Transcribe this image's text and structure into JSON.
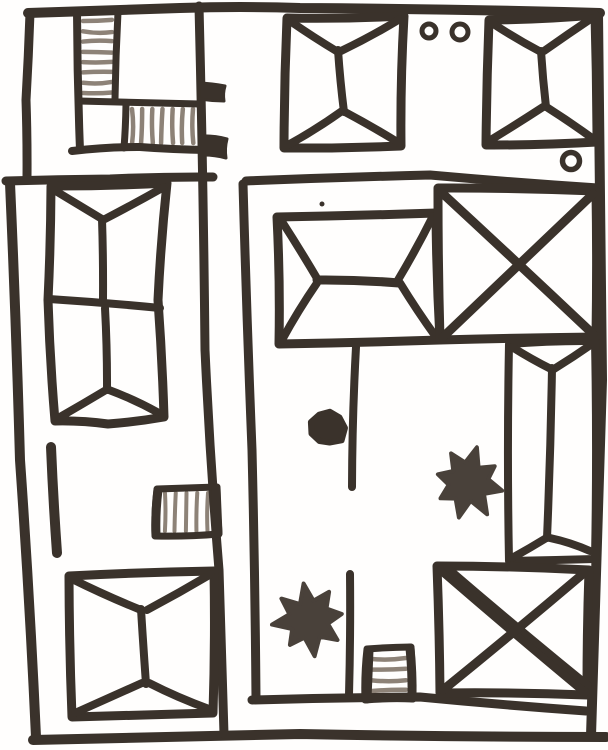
{
  "meta": {
    "description": "Hand-drawn black marker sketch of a walled compound map: hip-roofed buildings, X-roof buildings, hatched stair strips, star and dot markers, small circles. No text labels.",
    "canvas": {
      "w": 608,
      "h": 750
    }
  },
  "palette": {
    "ink": "#3a322b",
    "soft": "#49413a",
    "hatch": "#8d8277",
    "paper": "#fffefd"
  },
  "strokes": [
    {
      "name": "border-top",
      "pts": [
        [
          28,
          13
        ],
        [
          180,
          8
        ],
        [
          300,
          8
        ],
        [
          600,
          13
        ]
      ],
      "w": 10
    },
    {
      "name": "border-top-left-vertical",
      "pts": [
        [
          30,
          13
        ],
        [
          26,
          100
        ],
        [
          27,
          178
        ]
      ],
      "w": 9
    },
    {
      "name": "left-section-top-wall",
      "pts": [
        [
          6,
          181
        ],
        [
          110,
          179
        ],
        [
          213,
          177
        ]
      ],
      "w": 9
    },
    {
      "name": "border-left",
      "pts": [
        [
          10,
          183
        ],
        [
          20,
          460
        ],
        [
          36,
          737
        ]
      ],
      "w": 10
    },
    {
      "name": "border-right",
      "pts": [
        [
          598,
          14
        ],
        [
          602,
          380
        ],
        [
          591,
          736
        ]
      ],
      "w": 10
    },
    {
      "name": "border-bottom",
      "pts": [
        [
          33,
          740
        ],
        [
          300,
          734
        ],
        [
          606,
          737
        ]
      ],
      "w": 10
    },
    {
      "name": "street-wall",
      "pts": [
        [
          199,
          6
        ],
        [
          205,
          350
        ],
        [
          219,
          570
        ],
        [
          224,
          734
        ]
      ],
      "w": 9
    },
    {
      "name": "courtyard-left-wall",
      "pts": [
        [
          243,
          184
        ],
        [
          252,
          450
        ],
        [
          256,
          698
        ]
      ],
      "w": 9
    },
    {
      "name": "courtyard-top-wall",
      "pts": [
        [
          246,
          181
        ],
        [
          430,
          175
        ],
        [
          598,
          188
        ]
      ],
      "w": 9
    },
    {
      "name": "courtyard-bottom-wall",
      "pts": [
        [
          252,
          700
        ],
        [
          420,
          697
        ],
        [
          586,
          711
        ]
      ],
      "w": 9
    },
    {
      "name": "stairs-block-left-wall",
      "pts": [
        [
          77,
          12
        ],
        [
          80,
          150
        ]
      ],
      "w": 8
    },
    {
      "name": "stairs-block-bottom-wall",
      "pts": [
        [
          72,
          151
        ],
        [
          140,
          147
        ],
        [
          207,
          150
        ]
      ],
      "w": 8
    },
    {
      "name": "stairs-strip-right-wall",
      "pts": [
        [
          118,
          12
        ],
        [
          115,
          99
        ]
      ],
      "w": 7
    },
    {
      "name": "stairs-strip-bottom-wall",
      "pts": [
        [
          79,
          101
        ],
        [
          200,
          104
        ]
      ],
      "w": 7
    },
    {
      "name": "stairs-box-left-wall",
      "pts": [
        [
          126,
          104
        ],
        [
          124,
          148
        ]
      ],
      "w": 7
    },
    {
      "name": "building-top-middle-outline",
      "pts": [
        [
          287,
          18
        ],
        [
          404,
          16
        ],
        [
          401,
          146
        ],
        [
          284,
          148
        ]
      ],
      "closed": true,
      "w": 9
    },
    {
      "name": "building-top-middle-ridge",
      "pts": [
        [
          338,
          50
        ],
        [
          344,
          112
        ]
      ],
      "w": 8
    },
    {
      "name": "building-top-middle-hip-nw",
      "pts": [
        [
          290,
          21
        ],
        [
          338,
          52
        ]
      ],
      "w": 8
    },
    {
      "name": "building-top-middle-hip-ne",
      "pts": [
        [
          400,
          19
        ],
        [
          341,
          51
        ]
      ],
      "w": 8
    },
    {
      "name": "building-top-middle-hip-sw",
      "pts": [
        [
          288,
          145
        ],
        [
          342,
          111
        ]
      ],
      "w": 8
    },
    {
      "name": "building-top-middle-hip-se",
      "pts": [
        [
          399,
          143
        ],
        [
          345,
          112
        ]
      ],
      "w": 8
    },
    {
      "name": "building-top-right-outline",
      "pts": [
        [
          489,
          20
        ],
        [
          595,
          15
        ],
        [
          597,
          142
        ],
        [
          486,
          145
        ]
      ],
      "closed": true,
      "w": 9
    },
    {
      "name": "building-top-right-ridge",
      "pts": [
        [
          541,
          51
        ],
        [
          546,
          107
        ]
      ],
      "w": 8
    },
    {
      "name": "building-top-right-hip-nw",
      "pts": [
        [
          492,
          23
        ],
        [
          541,
          52
        ]
      ],
      "w": 8
    },
    {
      "name": "building-top-right-hip-ne",
      "pts": [
        [
          592,
          18
        ],
        [
          544,
          51
        ]
      ],
      "w": 8
    },
    {
      "name": "building-top-right-hip-sw",
      "pts": [
        [
          489,
          141
        ],
        [
          543,
          107
        ]
      ],
      "w": 8
    },
    {
      "name": "building-top-right-hip-se",
      "pts": [
        [
          592,
          138
        ],
        [
          548,
          108
        ]
      ],
      "w": 8
    },
    {
      "name": "building-left-outline",
      "pts": [
        [
          51,
          186
        ],
        [
          167,
          183
        ],
        [
          158,
          300
        ],
        [
          164,
          417
        ],
        [
          108,
          424
        ],
        [
          55,
          421
        ],
        [
          48,
          300
        ]
      ],
      "closed": true,
      "w": 9
    },
    {
      "name": "building-left-hip-nw",
      "pts": [
        [
          54,
          190
        ],
        [
          102,
          219
        ]
      ],
      "w": 8
    },
    {
      "name": "building-left-hip-ne",
      "pts": [
        [
          164,
          187
        ],
        [
          105,
          219
        ]
      ],
      "w": 8
    },
    {
      "name": "building-left-ridge-upper",
      "pts": [
        [
          102,
          219
        ],
        [
          103,
          299
        ]
      ],
      "w": 8
    },
    {
      "name": "building-left-divider",
      "pts": [
        [
          49,
          299
        ],
        [
          160,
          308
        ]
      ],
      "w": 8
    },
    {
      "name": "building-left-ridge-lower",
      "pts": [
        [
          105,
          308
        ],
        [
          107,
          390
        ]
      ],
      "w": 8
    },
    {
      "name": "building-left-hip-sw",
      "pts": [
        [
          60,
          417
        ],
        [
          106,
          390
        ]
      ],
      "w": 8
    },
    {
      "name": "building-left-hip-se",
      "pts": [
        [
          157,
          412
        ],
        [
          109,
          390
        ]
      ],
      "w": 8
    },
    {
      "name": "wall-fragment",
      "pts": [
        [
          51,
          447
        ],
        [
          57,
          553
        ]
      ],
      "w": 10
    },
    {
      "name": "stairs-left-outline",
      "pts": [
        [
          157,
          489
        ],
        [
          217,
          487
        ],
        [
          219,
          534
        ],
        [
          155,
          536
        ]
      ],
      "closed": true,
      "w": 7
    },
    {
      "name": "stairs-left-edge-left",
      "pts": [
        [
          158,
          490
        ],
        [
          156,
          535
        ]
      ],
      "w": 9
    },
    {
      "name": "stairs-left-edge-right",
      "pts": [
        [
          216,
          488
        ],
        [
          218,
          533
        ]
      ],
      "w": 9
    },
    {
      "name": "building-bottom-left-outline",
      "pts": [
        [
          69,
          576
        ],
        [
          214,
          571
        ],
        [
          213,
          713
        ],
        [
          72,
          717
        ]
      ],
      "closed": true,
      "w": 9
    },
    {
      "name": "building-bottom-left-ridge",
      "pts": [
        [
          141,
          609
        ],
        [
          146,
          684
        ]
      ],
      "w": 8
    },
    {
      "name": "building-bottom-left-hip-nw",
      "pts": [
        [
          72,
          579
        ],
        [
          141,
          610
        ]
      ],
      "w": 8
    },
    {
      "name": "building-bottom-left-hip-ne",
      "pts": [
        [
          211,
          574
        ],
        [
          147,
          610
        ]
      ],
      "w": 8
    },
    {
      "name": "building-bottom-left-hip-sw",
      "pts": [
        [
          75,
          713
        ],
        [
          142,
          683
        ]
      ],
      "w": 8
    },
    {
      "name": "building-bottom-left-hip-se",
      "pts": [
        [
          209,
          709
        ],
        [
          149,
          683
        ]
      ],
      "w": 8
    },
    {
      "name": "building-center-outline",
      "pts": [
        [
          277,
          217
        ],
        [
          436,
          213
        ],
        [
          440,
          340
        ],
        [
          279,
          344
        ]
      ],
      "closed": true,
      "w": 9
    },
    {
      "name": "building-center-ridge",
      "pts": [
        [
          317,
          280
        ],
        [
          399,
          283
        ]
      ],
      "w": 9
    },
    {
      "name": "building-center-hip-nw",
      "pts": [
        [
          281,
          220
        ],
        [
          318,
          280
        ]
      ],
      "w": 8
    },
    {
      "name": "building-center-hip-ne",
      "pts": [
        [
          433,
          216
        ],
        [
          398,
          280
        ]
      ],
      "w": 8
    },
    {
      "name": "building-center-hip-sw",
      "pts": [
        [
          282,
          340
        ],
        [
          317,
          283
        ]
      ],
      "w": 8
    },
    {
      "name": "building-center-hip-se",
      "pts": [
        [
          436,
          337
        ],
        [
          400,
          283
        ]
      ],
      "w": 8
    },
    {
      "name": "courtyard-inner-wall-upper",
      "pts": [
        [
          356,
          347
        ],
        [
          352,
          487
        ]
      ],
      "w": 8
    },
    {
      "name": "courtyard-inner-wall-lower",
      "pts": [
        [
          350,
          574
        ],
        [
          349,
          695
        ]
      ],
      "w": 8
    },
    {
      "name": "building-x-top-outline",
      "pts": [
        [
          438,
          188
        ],
        [
          596,
          191
        ],
        [
          596,
          337
        ],
        [
          440,
          340
        ]
      ],
      "closed": true,
      "w": 9
    },
    {
      "name": "building-x-top-diagonal-a",
      "pts": [
        [
          441,
          192
        ],
        [
          593,
          334
        ]
      ],
      "w": 9
    },
    {
      "name": "building-x-top-diagonal-b",
      "pts": [
        [
          593,
          194
        ],
        [
          443,
          337
        ]
      ],
      "w": 9
    },
    {
      "name": "building-right-outline",
      "pts": [
        [
          509,
          344
        ],
        [
          595,
          341
        ],
        [
          595,
          559
        ],
        [
          509,
          561
        ]
      ],
      "closed": true,
      "w": 8
    },
    {
      "name": "building-right-ridge",
      "pts": [
        [
          552,
          368
        ],
        [
          547,
          538
        ]
      ],
      "w": 8
    },
    {
      "name": "building-right-hip-nw",
      "pts": [
        [
          512,
          347
        ],
        [
          551,
          369
        ]
      ],
      "w": 8
    },
    {
      "name": "building-right-hip-ne",
      "pts": [
        [
          592,
          344
        ],
        [
          554,
          369
        ]
      ],
      "w": 8
    },
    {
      "name": "building-right-hip-sw",
      "pts": [
        [
          512,
          558
        ],
        [
          548,
          537
        ]
      ],
      "w": 8
    },
    {
      "name": "building-right-hip-se",
      "pts": [
        [
          590,
          551
        ],
        [
          550,
          538
        ]
      ],
      "w": 8
    },
    {
      "name": "building-x-bottom-outline",
      "pts": [
        [
          437,
          566
        ],
        [
          589,
          570
        ],
        [
          587,
          695
        ],
        [
          440,
          693
        ]
      ],
      "closed": true,
      "w": 9
    },
    {
      "name": "building-x-bottom-diagonal-a",
      "pts": [
        [
          441,
          570
        ],
        [
          585,
          692
        ]
      ],
      "w": 9
    },
    {
      "name": "building-x-bottom-diagonal-a2",
      "pts": [
        [
          447,
          567
        ],
        [
          588,
          685
        ]
      ],
      "w": 7
    },
    {
      "name": "building-x-bottom-diagonal-b",
      "pts": [
        [
          584,
          573
        ],
        [
          443,
          690
        ]
      ],
      "w": 9
    },
    {
      "name": "stairs-bottom-outline",
      "pts": [
        [
          367,
          649
        ],
        [
          411,
          647
        ],
        [
          413,
          699
        ],
        [
          365,
          700
        ]
      ],
      "closed": true,
      "w": 7
    },
    {
      "name": "stairs-bottom-edge-left",
      "pts": [
        [
          369,
          650
        ],
        [
          367,
          699
        ]
      ],
      "w": 9
    },
    {
      "name": "stairs-bottom-edge-right",
      "pts": [
        [
          410,
          648
        ],
        [
          412,
          698
        ]
      ],
      "w": 9
    }
  ],
  "hatch_sets": [
    {
      "name": "stairs-vertical-treads",
      "dir": "h",
      "x1": 83,
      "x2": 112,
      "yStart": 21,
      "yEnd": 93,
      "count": 8,
      "w": 4.5,
      "color": "hatch"
    },
    {
      "name": "stairs-horizontal-treads",
      "dir": "v",
      "y1": 109,
      "y2": 143,
      "xStart": 132,
      "xEnd": 193,
      "count": 7,
      "w": 4.5,
      "color": "hatch"
    },
    {
      "name": "stairs-left-treads",
      "dir": "v",
      "y1": 493,
      "y2": 531,
      "xStart": 165,
      "xEnd": 208,
      "count": 5,
      "w": 4,
      "color": "hatch"
    },
    {
      "name": "stairs-bottom-treads",
      "dir": "h",
      "x1": 372,
      "x2": 406,
      "yStart": 659,
      "yEnd": 691,
      "count": 4,
      "w": 4.5,
      "color": "hatch"
    }
  ],
  "rings": [
    {
      "name": "small-circle-a",
      "cx": 429,
      "cy": 31,
      "r": 7,
      "w": 5
    },
    {
      "name": "small-circle-b",
      "cx": 460,
      "cy": 32,
      "r": 8,
      "w": 5
    },
    {
      "name": "small-circle-c",
      "cx": 571,
      "cy": 161,
      "r": 8.5,
      "w": 5.5
    }
  ],
  "tabs": [
    {
      "name": "street-tab-upper",
      "pts": [
        [
          199,
          83
        ],
        [
          225,
          86
        ],
        [
          224,
          101
        ],
        [
          199,
          99
        ]
      ]
    },
    {
      "name": "street-tab-lower",
      "pts": [
        [
          201,
          136
        ],
        [
          227,
          139
        ],
        [
          226,
          158
        ],
        [
          201,
          155
        ]
      ]
    }
  ],
  "stars": [
    {
      "name": "star-marker-right",
      "cx": 468,
      "cy": 482,
      "rOuter": 34,
      "rInner": 19,
      "points": 8,
      "rot": 0.25
    },
    {
      "name": "star-marker-bottom",
      "cx": 309,
      "cy": 619,
      "rOuter": 36,
      "rInner": 19,
      "points": 8,
      "rot": -0.15
    }
  ],
  "blobs": [
    {
      "name": "dot-marker-large",
      "cx": 327,
      "cy": 428,
      "r": 17
    }
  ],
  "dots": [
    {
      "name": "dot-speck",
      "cx": 322,
      "cy": 204,
      "r": 2.5
    }
  ]
}
